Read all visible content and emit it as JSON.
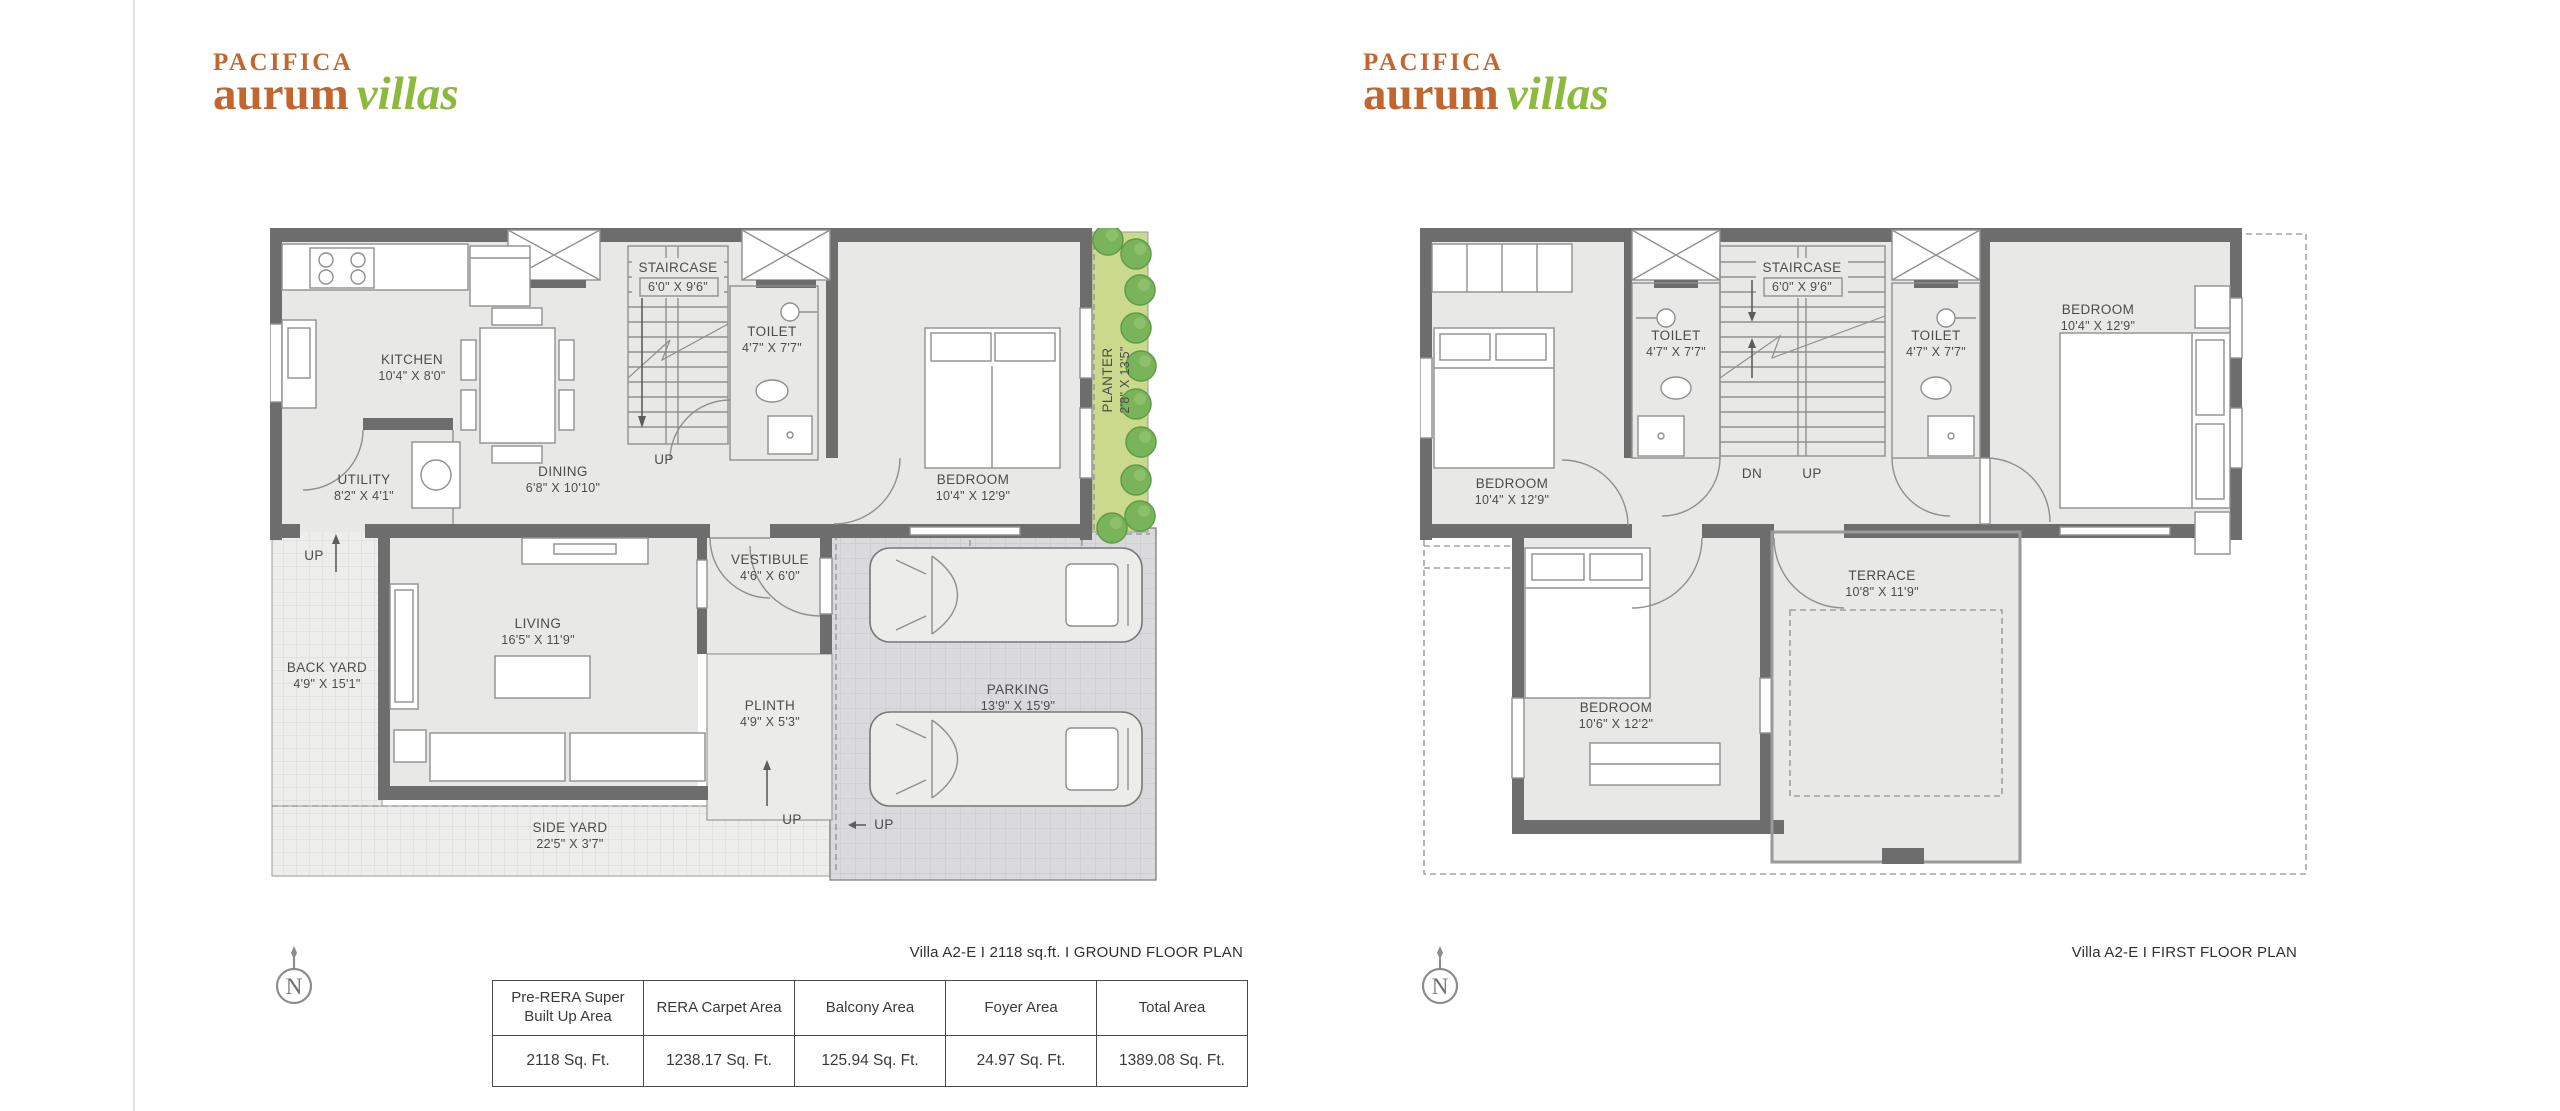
{
  "brand": {
    "name": "PACIFICA",
    "word_main": "aurum",
    "word_accent": "villas"
  },
  "colors": {
    "brand_orange": "#c2652e",
    "brand_green": "#8db93c",
    "wall_gray": "#6d6d6d",
    "plan_fill": "#e8e8e7",
    "planter_green": "#cbd98c"
  },
  "ground_floor": {
    "caption": "Villa A2-E I 2118 sq.ft. I GROUND FLOOR PLAN",
    "rooms": [
      {
        "name": "KITCHEN",
        "dims": "10'4\" X 8'0\""
      },
      {
        "name": "DINING",
        "dims": "6'8\" X 10'10\""
      },
      {
        "name": "STAIRCASE",
        "dims": "6'0\" X 9'6\""
      },
      {
        "name": "TOILET",
        "dims": "4'7\" X 7'7\""
      },
      {
        "name": "UTILITY",
        "dims": "8'2\" X 4'1\""
      },
      {
        "name": "BEDROOM",
        "dims": "10'4\" X 12'9\""
      },
      {
        "name": "PLANTER",
        "dims": "2'8\" X 13'5\""
      },
      {
        "name": "VESTIBULE",
        "dims": "4'6\" X 6'0\""
      },
      {
        "name": "LIVING",
        "dims": "16'5\" X 11'9\""
      },
      {
        "name": "BACK YARD",
        "dims": "4'9\" X 15'1\""
      },
      {
        "name": "PLINTH",
        "dims": "4'9\" X 5'3\""
      },
      {
        "name": "PARKING",
        "dims": "13'9\" X 15'9\""
      },
      {
        "name": "SIDE YARD",
        "dims": "22'5\" X 3'7\""
      }
    ],
    "labels": {
      "stair_up": "UP",
      "backyard_up": "UP",
      "plinth_up": "UP",
      "entry_up": "UP"
    }
  },
  "first_floor": {
    "caption": "Villa A2-E I FIRST FLOOR PLAN",
    "rooms": [
      {
        "name": "BEDROOM",
        "dims": "10'4\" X 12'9\""
      },
      {
        "name": "TOILET",
        "dims": "4'7\" X 7'7\""
      },
      {
        "name": "STAIRCASE",
        "dims": "6'0\" X 9'6\""
      },
      {
        "name": "TOILET",
        "dims": "4'7\" X 7'7\""
      },
      {
        "name": "BEDROOM",
        "dims": "10'4\" X 12'9\""
      },
      {
        "name": "BEDROOM",
        "dims": "10'6\" X 12'2\""
      },
      {
        "name": "TERRACE",
        "dims": "10'8\" X 11'9\""
      }
    ],
    "labels": {
      "dn": "DN",
      "up": "UP"
    }
  },
  "area_table": {
    "headers": [
      "Pre-RERA Super Built Up Area",
      "RERA Carpet Area",
      "Balcony Area",
      "Foyer Area",
      "Total Area"
    ],
    "values": [
      "2118 Sq. Ft.",
      "1238.17 Sq. Ft.",
      "125.94 Sq. Ft.",
      "24.97 Sq. Ft.",
      "1389.08 Sq. Ft."
    ]
  },
  "compass": {
    "letter": "N"
  }
}
